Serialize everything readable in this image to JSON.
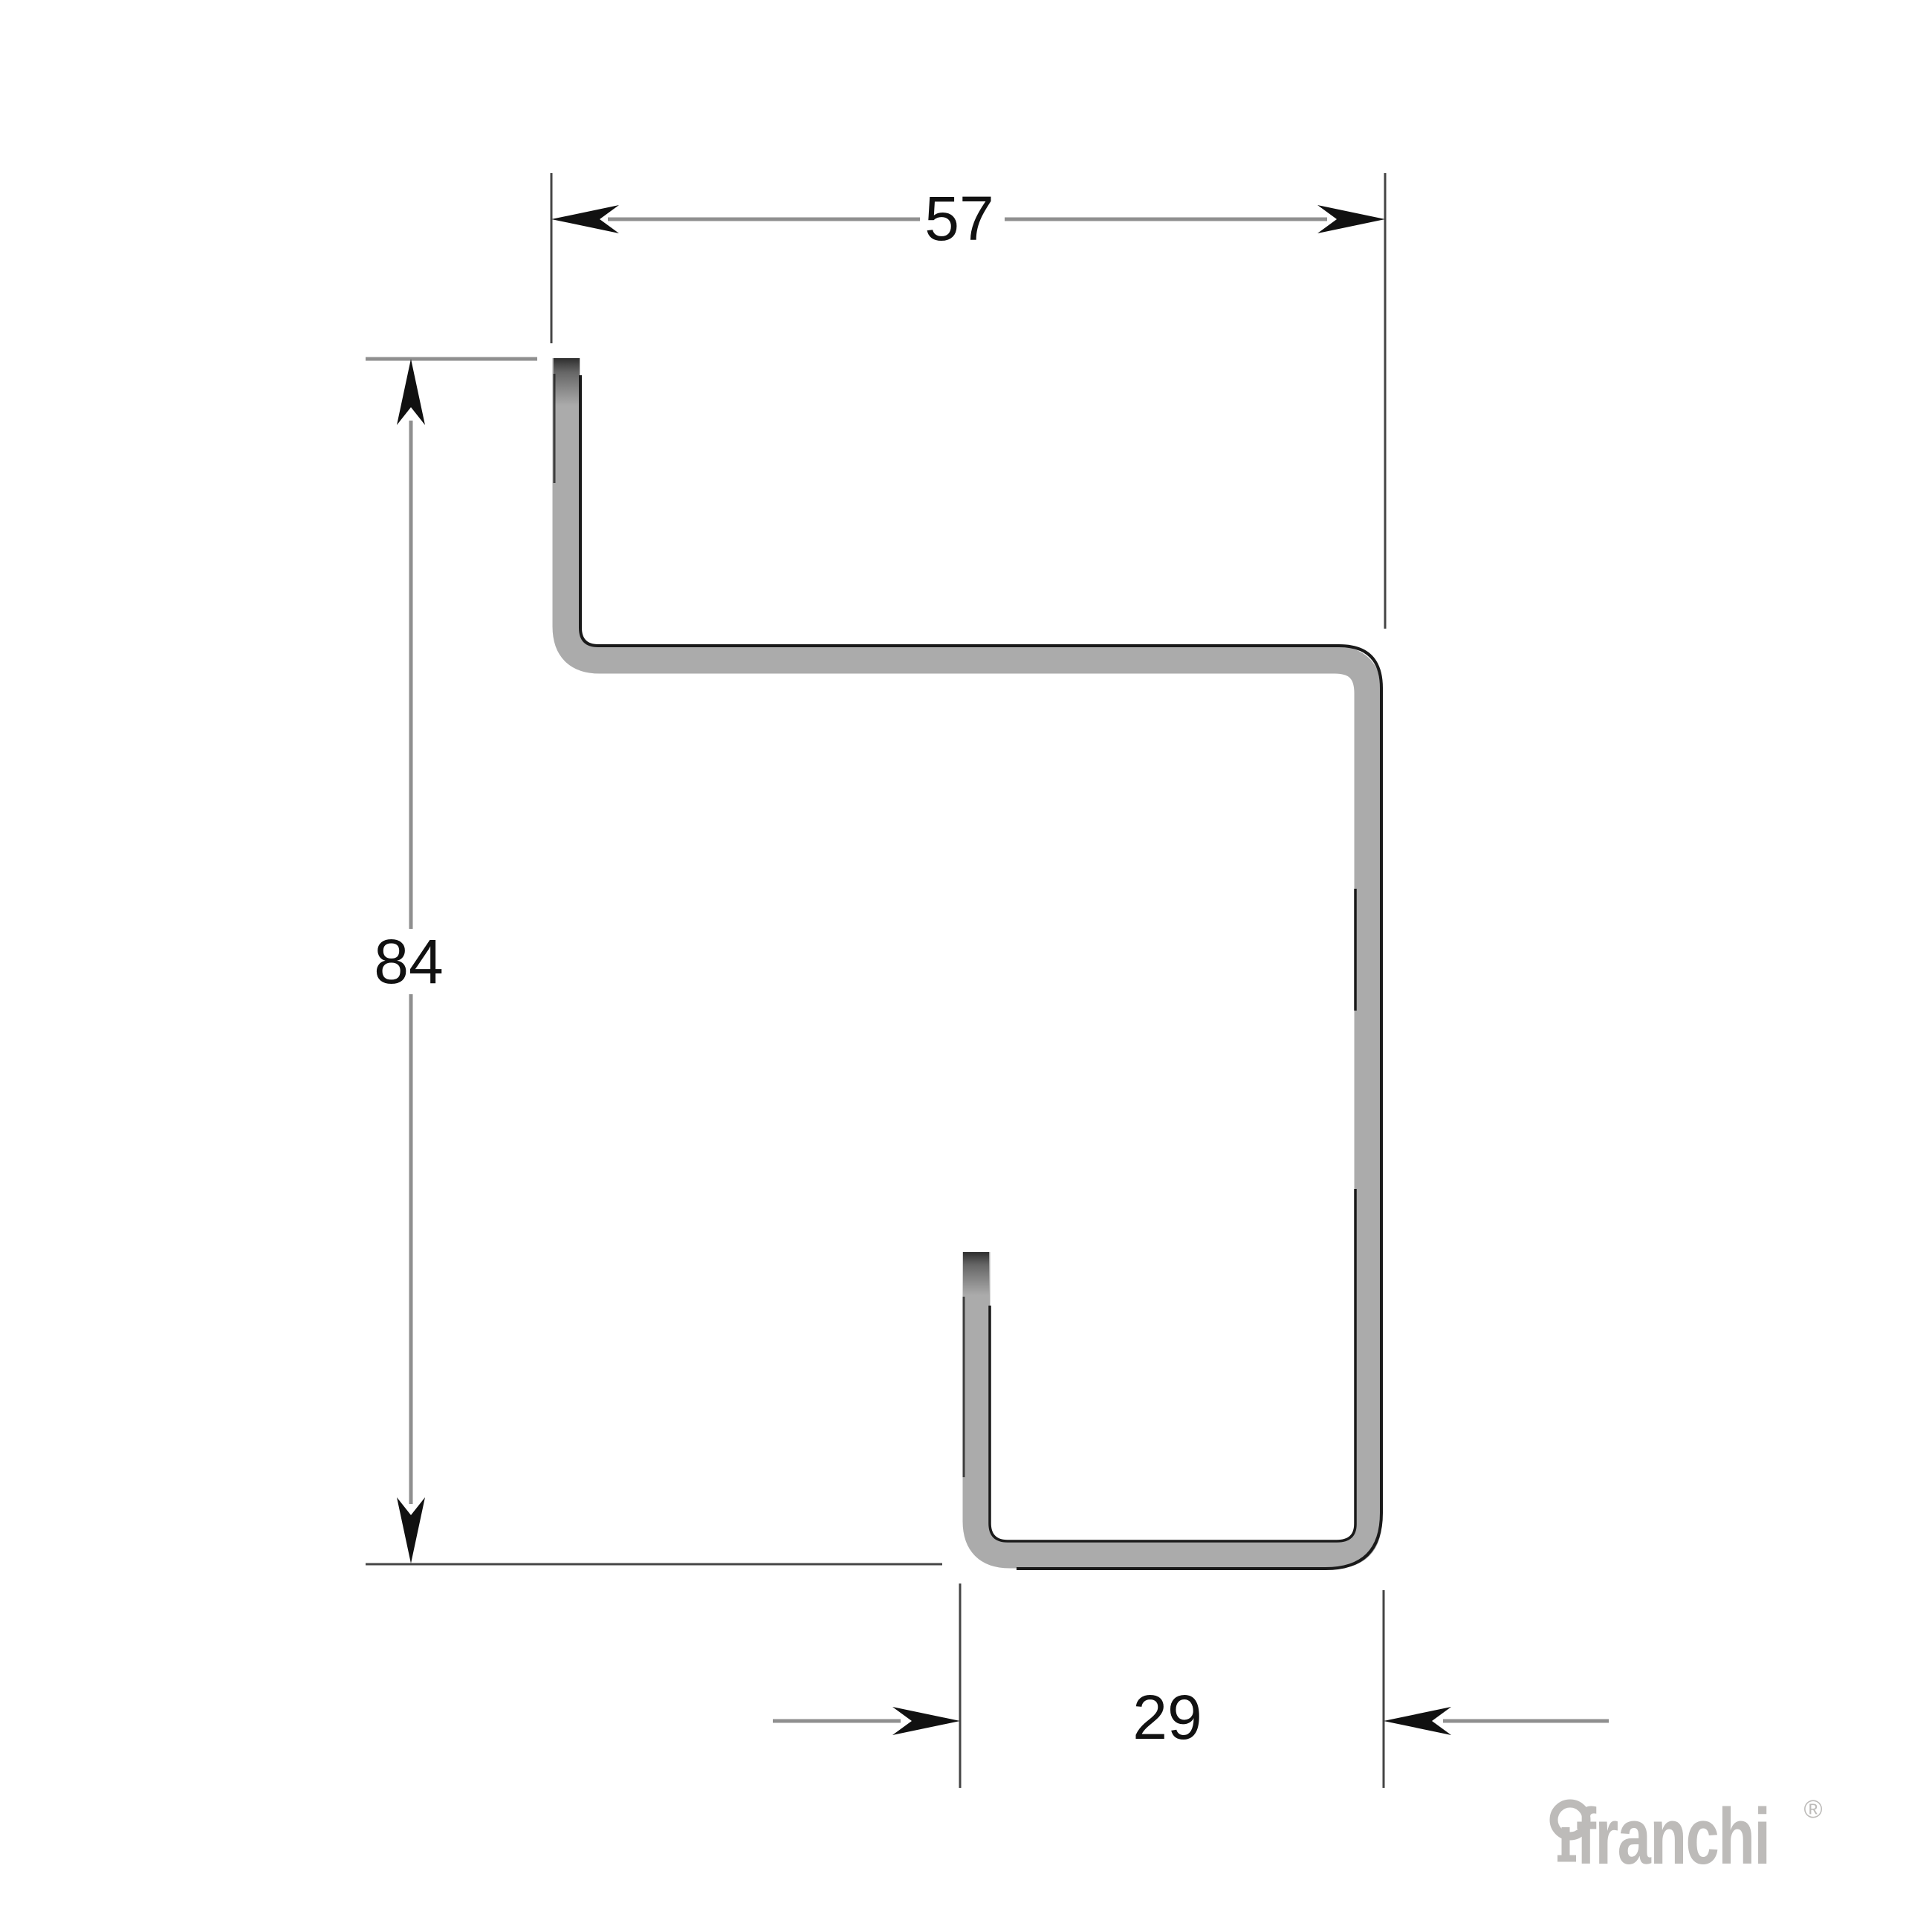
{
  "page": {
    "background": "#ffffff",
    "description": "Technical cross-section drawing of a bent sheet-metal profile with three dimensions"
  },
  "drawing": {
    "type": "sheet-metal profile cross-section",
    "dimensions": {
      "top_width": "57",
      "height": "84",
      "bottom_width": "29"
    },
    "colors": {
      "profile_fill": "#ababab",
      "outline": "#1a1a1a",
      "dimension_line": "#8f8f8f",
      "extension_line": "#454545",
      "arrow": "#111111",
      "label_text": "#111111"
    }
  },
  "branding": {
    "logo_text": "franchi",
    "registered_mark": "®",
    "logo_color": "#bdbbb9"
  }
}
